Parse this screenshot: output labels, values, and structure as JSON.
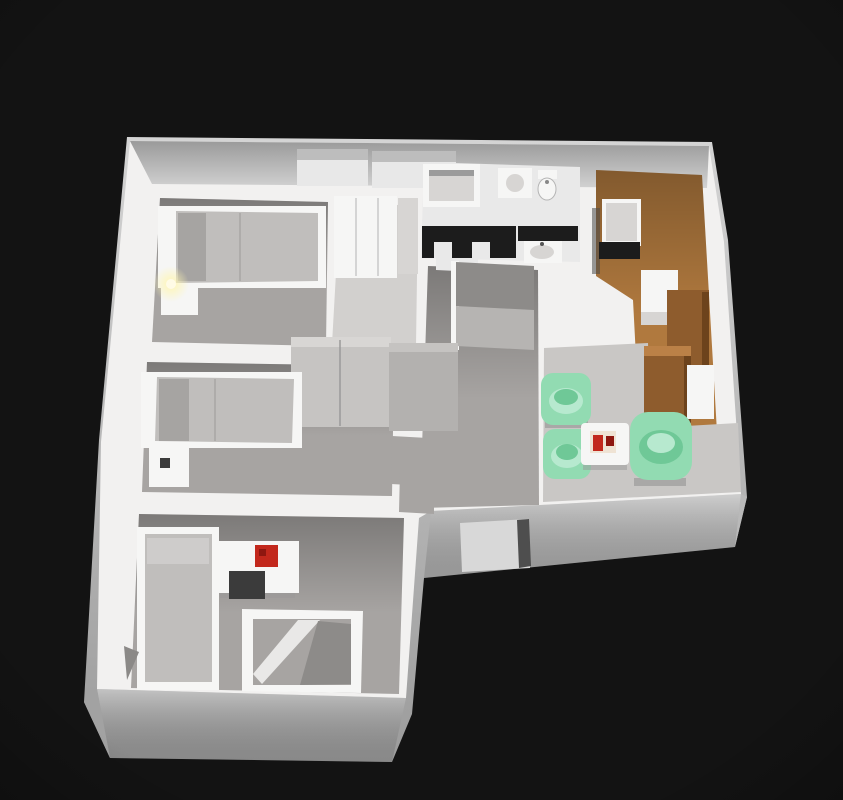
{
  "scene": {
    "type": "3d-floor-plan-render",
    "description": "Isometric 3D rendering of an apartment floor plan on a dark background",
    "colors": {
      "background": "#131313",
      "wall": "#f2f1f0",
      "bath_floor": "#e9e9e9",
      "closet_floor": "#d2d0ce",
      "floor": "#a7a4a2",
      "floor_light": "#c9c7c5",
      "wood_floor": "#b0793e",
      "wood_cab": "#8e5c2d",
      "wood_cab_dark": "#6d431c",
      "wood_top": "#bb8147",
      "white_furn": "#f6f6f5",
      "gray_furn": "#d7d5d3",
      "mattress": "#c0bebc",
      "mattress_dark": "#a6a4a2",
      "pillow": "#cecccb",
      "green": "#92dbb2",
      "green_mid": "#6fc897",
      "green_light": "#b7e9cf",
      "red": "#c2281c",
      "red_dark": "#8e1710",
      "tray": "#efe3d4",
      "black": "#1c1c1c",
      "dark_chair": "#3b3b3b",
      "wardrobe_gray": "#c6c4c2",
      "wardrobe_gray_dark": "#b3b1af",
      "niche_dark": "#8d8b89",
      "niche_mid": "#b6b4b2",
      "window_glass": "#d8d8d8",
      "frame_dark": "#4e4e4e",
      "glow_core": "#fffbe6"
    },
    "rooms": [
      {
        "id": "bedroom-1",
        "contents": [
          "double-bed",
          "nightstand-with-lamp",
          "wardrobe"
        ]
      },
      {
        "id": "bathroom",
        "contents": [
          "bathtub",
          "toilet",
          "black-vanity-counter",
          "sink"
        ]
      },
      {
        "id": "kitchen",
        "contents": [
          "table",
          "stove",
          "counters",
          "wood-floor"
        ]
      },
      {
        "id": "living-area",
        "contents": [
          "green-armchair",
          "green-armchair",
          "large-green-armchair",
          "coffee-table-with-red-decor",
          "wood-cabinet"
        ]
      },
      {
        "id": "hallway",
        "contents": [
          "storage-niche"
        ]
      },
      {
        "id": "bedroom-2",
        "contents": [
          "single-bed",
          "nightstand",
          "wardrobes"
        ]
      },
      {
        "id": "bedroom-3",
        "contents": [
          "single-bed",
          "desk-with-red-accent",
          "office-chair",
          "alcove"
        ]
      }
    ]
  }
}
